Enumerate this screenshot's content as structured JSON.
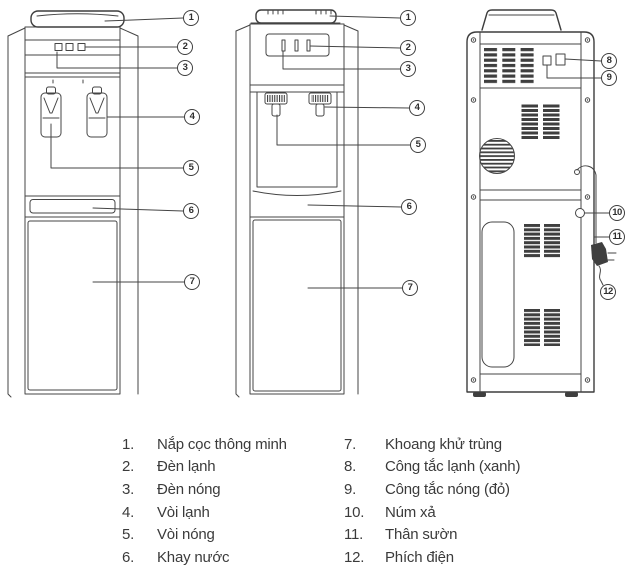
{
  "figure": {
    "description": "Water dispenser parts diagram: two front views and one rear view with numbered callouts",
    "callouts": {
      "1": "1",
      "2": "2",
      "3": "3",
      "4": "4",
      "5": "5",
      "6": "6",
      "7": "7",
      "8": "8",
      "9": "9",
      "10": "10",
      "11": "11",
      "12": "12"
    }
  },
  "legend": {
    "left": [
      {
        "num": "1.",
        "label": "Nắp cọc thông minh"
      },
      {
        "num": "2.",
        "label": "Đèn lạnh"
      },
      {
        "num": "3.",
        "label": "Đèn nóng"
      },
      {
        "num": "4.",
        "label": "Vòi lạnh"
      },
      {
        "num": "5.",
        "label": "Vòi nóng"
      },
      {
        "num": "6.",
        "label": "Khay nước"
      }
    ],
    "right": [
      {
        "num": "7.",
        "label": "Khoang khử trùng"
      },
      {
        "num": "8.",
        "label": "Công tắc lạnh (xanh)"
      },
      {
        "num": "9.",
        "label": "Công tắc nóng (đỏ)"
      },
      {
        "num": "10.",
        "label": "Núm xả"
      },
      {
        "num": "11.",
        "label": "Thân sườn"
      },
      {
        "num": "12.",
        "label": "Phích điện"
      }
    ]
  },
  "colors": {
    "line": "#454545",
    "text": "#3b3b3b",
    "background": "#ffffff"
  }
}
